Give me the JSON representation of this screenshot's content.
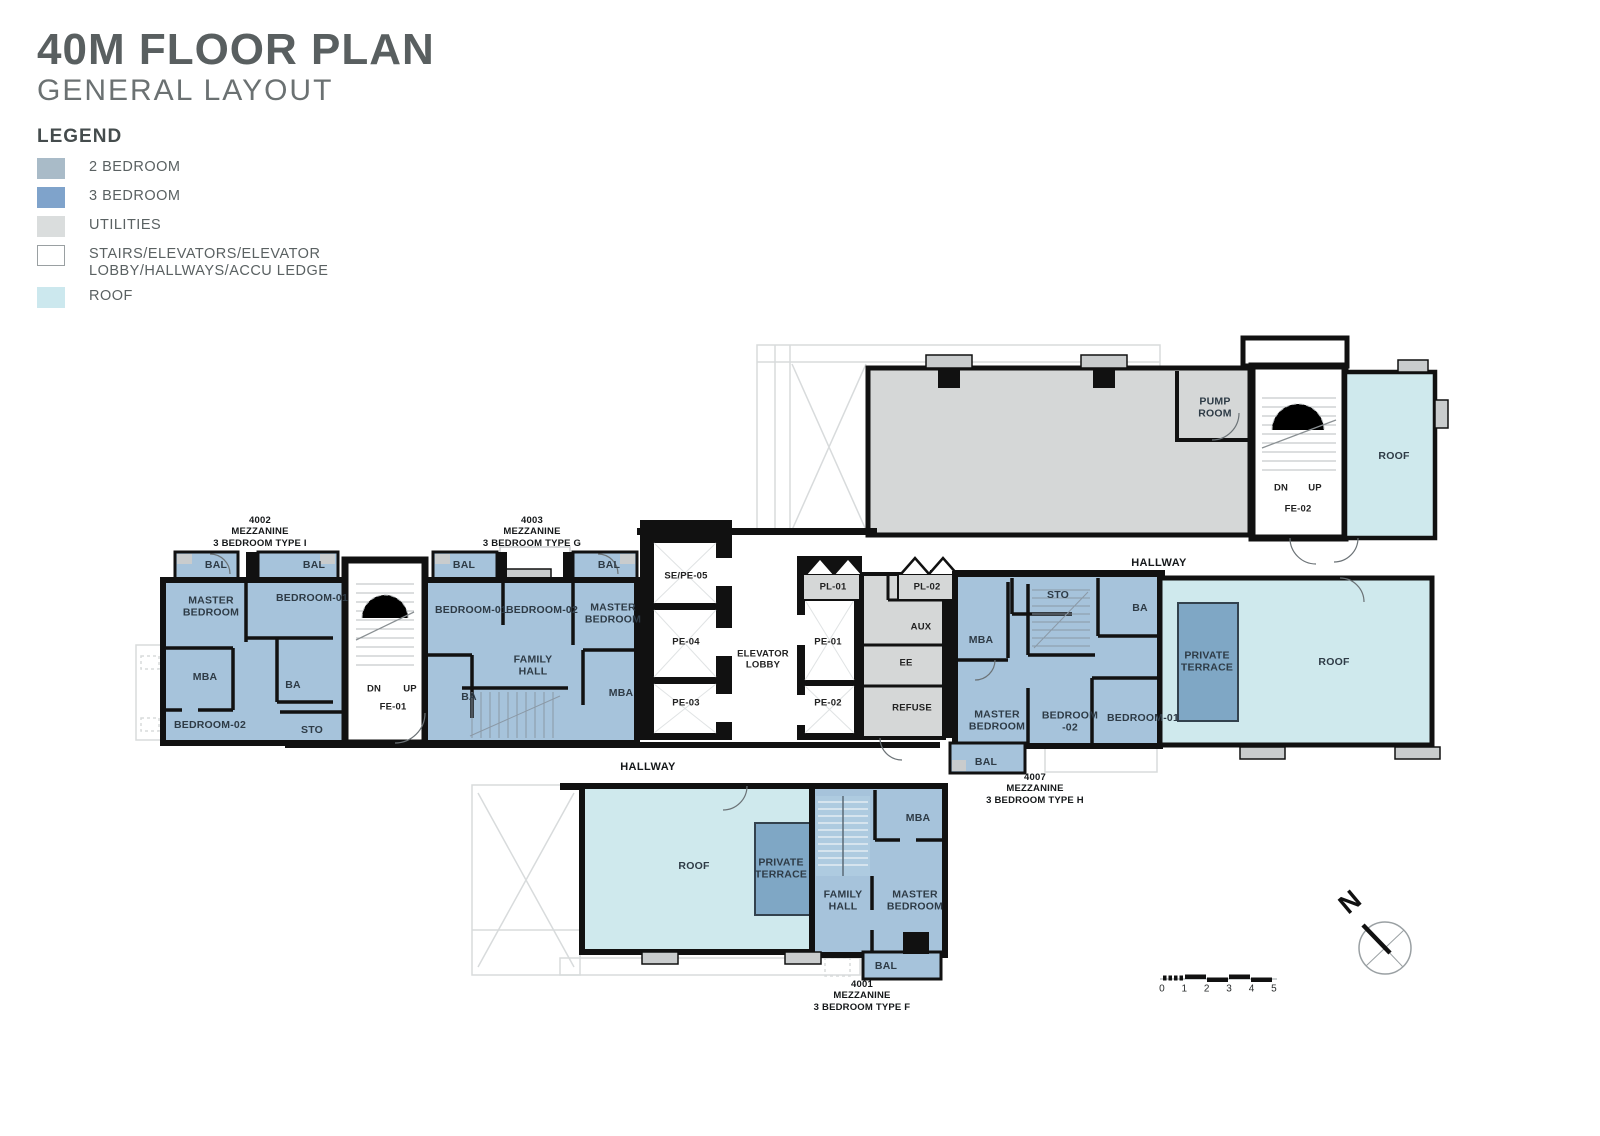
{
  "header": {
    "title": "40M FLOOR PLAN",
    "subtitle": "GENERAL LAYOUT",
    "legend_title": "LEGEND",
    "legend": [
      {
        "label": "2 BEDROOM",
        "color": "#a9bbc8",
        "outlined": false
      },
      {
        "label": "3 BEDROOM",
        "color": "#7fa3cb",
        "outlined": false
      },
      {
        "label": "UTILITIES",
        "color": "#dadddd",
        "outlined": false
      },
      {
        "label": "STAIRS/ELEVATORS/ELEVATOR\nLOBBY/HALLWAYS/ACCU LEDGE",
        "color": "#ffffff",
        "outlined": true
      },
      {
        "label": "ROOF",
        "color": "#cce8ee",
        "outlined": false
      }
    ]
  },
  "colors": {
    "unit_fill": "#a6c3db",
    "terrace_fill": "#7fa7c5",
    "roof_fill": "#cfe9ed",
    "utility_fill": "#d5d7d7",
    "wall": "#111111",
    "title_gray": "#595f60"
  },
  "plan": {
    "labels": [
      {
        "t": "4002\nMEZZANINE\n3 BEDROOM TYPE I",
        "x": 260,
        "y": 532,
        "c": "t",
        "n": "unit-4002-title"
      },
      {
        "t": "4003\nMEZZANINE\n3 BEDROOM TYPE G",
        "x": 532,
        "y": 532,
        "c": "t",
        "n": "unit-4003-title"
      },
      {
        "t": "4007\nMEZZANINE\n3 BEDROOM TYPE H",
        "x": 1035,
        "y": 789,
        "c": "t",
        "n": "unit-4007-title"
      },
      {
        "t": "4001\nMEZZANINE\n3 BEDROOM TYPE F",
        "x": 862,
        "y": 996,
        "c": "t",
        "n": "unit-4001-title"
      },
      {
        "t": "BAL",
        "x": 216,
        "y": 566,
        "c": "r"
      },
      {
        "t": "BAL",
        "x": 314,
        "y": 566,
        "c": "r"
      },
      {
        "t": "MASTER\nBEDROOM",
        "x": 211,
        "y": 607,
        "c": "r"
      },
      {
        "t": "BEDROOM-01",
        "x": 312,
        "y": 599,
        "c": "r"
      },
      {
        "t": "MBA",
        "x": 205,
        "y": 678,
        "c": "r"
      },
      {
        "t": "BA",
        "x": 293,
        "y": 686,
        "c": "r"
      },
      {
        "t": "BEDROOM-02",
        "x": 210,
        "y": 726,
        "c": "r"
      },
      {
        "t": "STO",
        "x": 312,
        "y": 731,
        "c": "r"
      },
      {
        "t": "DN",
        "x": 374,
        "y": 690,
        "c": "s"
      },
      {
        "t": "UP",
        "x": 410,
        "y": 690,
        "c": "s"
      },
      {
        "t": "FE-01",
        "x": 393,
        "y": 708,
        "c": "s"
      },
      {
        "t": "BAL",
        "x": 464,
        "y": 566,
        "c": "r"
      },
      {
        "t": "BAL",
        "x": 609,
        "y": 566,
        "c": "r"
      },
      {
        "t": "BEDROOM-01",
        "x": 471,
        "y": 611,
        "c": "r"
      },
      {
        "t": "BEDROOM-02",
        "x": 542,
        "y": 611,
        "c": "r"
      },
      {
        "t": "MASTER\nBEDROOM",
        "x": 613,
        "y": 614,
        "c": "r"
      },
      {
        "t": "FAMILY\nHALL",
        "x": 533,
        "y": 666,
        "c": "r"
      },
      {
        "t": "BA",
        "x": 469,
        "y": 698,
        "c": "r"
      },
      {
        "t": "MBA",
        "x": 621,
        "y": 694,
        "c": "r"
      },
      {
        "t": "SE/PE-05",
        "x": 686,
        "y": 577,
        "c": "s"
      },
      {
        "t": "PE-04",
        "x": 686,
        "y": 643,
        "c": "s"
      },
      {
        "t": "PE-03",
        "x": 686,
        "y": 704,
        "c": "s"
      },
      {
        "t": "ELEVATOR\nLOBBY",
        "x": 763,
        "y": 660,
        "c": "s"
      },
      {
        "t": "PL-01",
        "x": 833,
        "y": 588,
        "c": "s"
      },
      {
        "t": "PL-02",
        "x": 927,
        "y": 588,
        "c": "s"
      },
      {
        "t": "PE-01",
        "x": 828,
        "y": 643,
        "c": "s"
      },
      {
        "t": "PE-02",
        "x": 828,
        "y": 704,
        "c": "s"
      },
      {
        "t": "AUX",
        "x": 921,
        "y": 628,
        "c": "s"
      },
      {
        "t": "EE",
        "x": 906,
        "y": 664,
        "c": "s"
      },
      {
        "t": "REFUSE",
        "x": 912,
        "y": 709,
        "c": "s"
      },
      {
        "t": "STO",
        "x": 1058,
        "y": 596,
        "c": "r"
      },
      {
        "t": "BA",
        "x": 1140,
        "y": 609,
        "c": "r"
      },
      {
        "t": "MBA",
        "x": 981,
        "y": 641,
        "c": "r"
      },
      {
        "t": "MASTER\nBEDROOM",
        "x": 997,
        "y": 721,
        "c": "r"
      },
      {
        "t": "BEDROOM\n-02",
        "x": 1070,
        "y": 722,
        "c": "r"
      },
      {
        "t": "BEDROOM-01",
        "x": 1143,
        "y": 719,
        "c": "r"
      },
      {
        "t": "BAL",
        "x": 986,
        "y": 763,
        "c": "r"
      },
      {
        "t": "PRIVATE\nTERRACE",
        "x": 1207,
        "y": 662,
        "c": "r"
      },
      {
        "t": "ROOF",
        "x": 1334,
        "y": 663,
        "c": "r"
      },
      {
        "t": "HALLWAY",
        "x": 1159,
        "y": 563,
        "c": "h",
        "n": "hallway-label-top"
      },
      {
        "t": "PUMP\nROOM",
        "x": 1215,
        "y": 408,
        "c": "r",
        "n": "pump-room-label"
      },
      {
        "t": "DN",
        "x": 1281,
        "y": 489,
        "c": "s"
      },
      {
        "t": "UP",
        "x": 1315,
        "y": 489,
        "c": "s"
      },
      {
        "t": "FE-02",
        "x": 1298,
        "y": 510,
        "c": "s"
      },
      {
        "t": "ROOF",
        "x": 1394,
        "y": 457,
        "c": "r"
      },
      {
        "t": "HALLWAY",
        "x": 648,
        "y": 767,
        "c": "h",
        "n": "hallway-label-bottom"
      },
      {
        "t": "ROOF",
        "x": 694,
        "y": 867,
        "c": "r"
      },
      {
        "t": "PRIVATE\nTERRACE",
        "x": 781,
        "y": 869,
        "c": "r"
      },
      {
        "t": "FAMILY\nHALL",
        "x": 843,
        "y": 901,
        "c": "r"
      },
      {
        "t": "MBA",
        "x": 918,
        "y": 819,
        "c": "r"
      },
      {
        "t": "MASTER\nBEDROOM",
        "x": 915,
        "y": 901,
        "c": "r"
      },
      {
        "t": "BAL",
        "x": 886,
        "y": 967,
        "c": "r"
      }
    ],
    "scale": {
      "ticks": [
        "0",
        "1",
        "2",
        "3",
        "4",
        "5"
      ],
      "x0": 1162,
      "dx": 22.4,
      "y": 989
    },
    "north": {
      "label": "N",
      "x": 1350,
      "y": 902
    }
  }
}
